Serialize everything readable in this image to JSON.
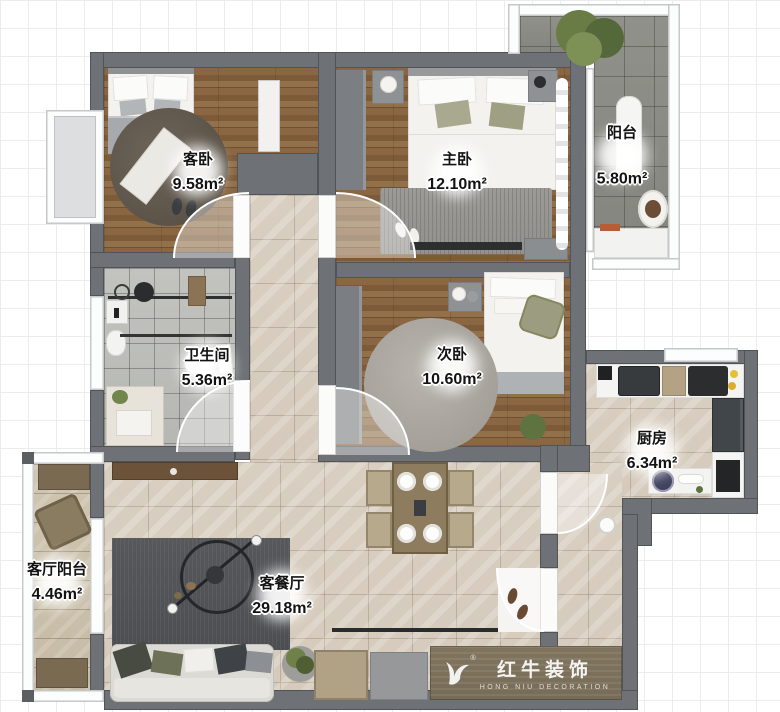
{
  "floorplan": {
    "rooms": [
      {
        "id": "guest_bedroom",
        "name": "客卧",
        "area": "9.58m²"
      },
      {
        "id": "master_bedroom",
        "name": "主卧",
        "area": "12.10m²"
      },
      {
        "id": "balcony",
        "name": "阳台",
        "area": "5.80m²"
      },
      {
        "id": "bathroom",
        "name": "卫生间",
        "area": "5.36m²"
      },
      {
        "id": "second_bedroom",
        "name": "次卧",
        "area": "10.60m²"
      },
      {
        "id": "kitchen",
        "name": "厨房",
        "area": "6.34m²"
      },
      {
        "id": "living_balcony",
        "name": "客厅阳台",
        "area": "4.46m²"
      },
      {
        "id": "living_dining",
        "name": "客餐厅",
        "area": "29.18m²"
      }
    ],
    "watermark": {
      "brand": "红牛装饰",
      "subtitle": "HONG NIU DECORATION",
      "registered": "®"
    },
    "colors": {
      "wall": "#6e7276",
      "wood_floor": "#85633f",
      "tile_beige": "#d8cec0",
      "tile_gray": "#8b8c85",
      "tile_bath": "#bcbdb9",
      "rug_dark": "#55565a",
      "rug_light": "#9b9995"
    }
  }
}
